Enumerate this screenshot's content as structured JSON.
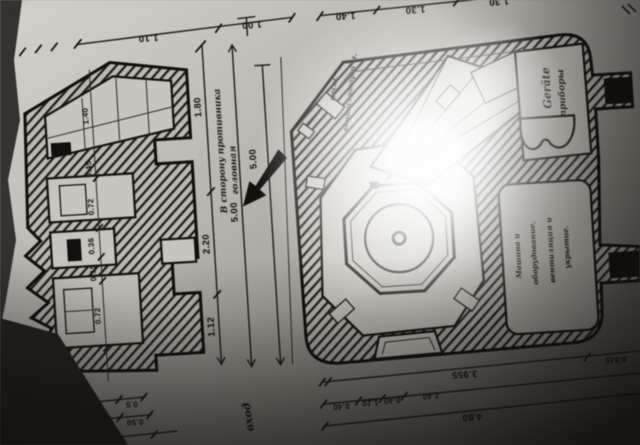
{
  "image": {
    "kind": "photograph of an old fortification blueprint, rotated upside down",
    "left_drawing": "cross-section of stepped casemate wall",
    "right_drawing": "plan of armoured turret block with central octagonal pedestal",
    "colors": {
      "paper": "#c6c3bc",
      "ink": "#15130e",
      "shadow": "#2a2723",
      "glare": "#ffffff"
    }
  },
  "dimensions": {
    "top_left": [
      "1.10",
      "1.00"
    ],
    "top_right": [
      "1.40",
      "1.30",
      "1.30",
      "15.04"
    ],
    "middle_chain": [
      "1.80",
      "2.20",
      "1.12"
    ],
    "middle_overall": [
      "5.00",
      "5.00"
    ],
    "section_chain": [
      "1.40",
      "0.45",
      "0.72",
      "0.36",
      "0.15",
      "0.72"
    ],
    "bottom_left_row1": [
      "1.05",
      "0.5"
    ],
    "bottom_left_row2": [
      "0.50",
      "1.86",
      "0.50"
    ],
    "bottom_left_row3": [
      "0.50",
      "2.50"
    ],
    "bottom_right_row1": [
      "3.955",
      "0.845"
    ],
    "bottom_right_row2": [
      "0.40",
      "1.20",
      "0.40",
      "2.40"
    ],
    "bottom_right_row3": [
      "4.80"
    ]
  },
  "annotations": {
    "direction_line1": "В сторону противника",
    "direction_line2": "головная",
    "entry": "вход",
    "equipment_room": [
      "Geräte",
      "приборы"
    ],
    "turret_notes": [
      "насос",
      "вентилятор и м."
    ],
    "machine_room": [
      "Машина и",
      "оборудование,",
      "вентиляция и",
      "укрытие."
    ]
  }
}
